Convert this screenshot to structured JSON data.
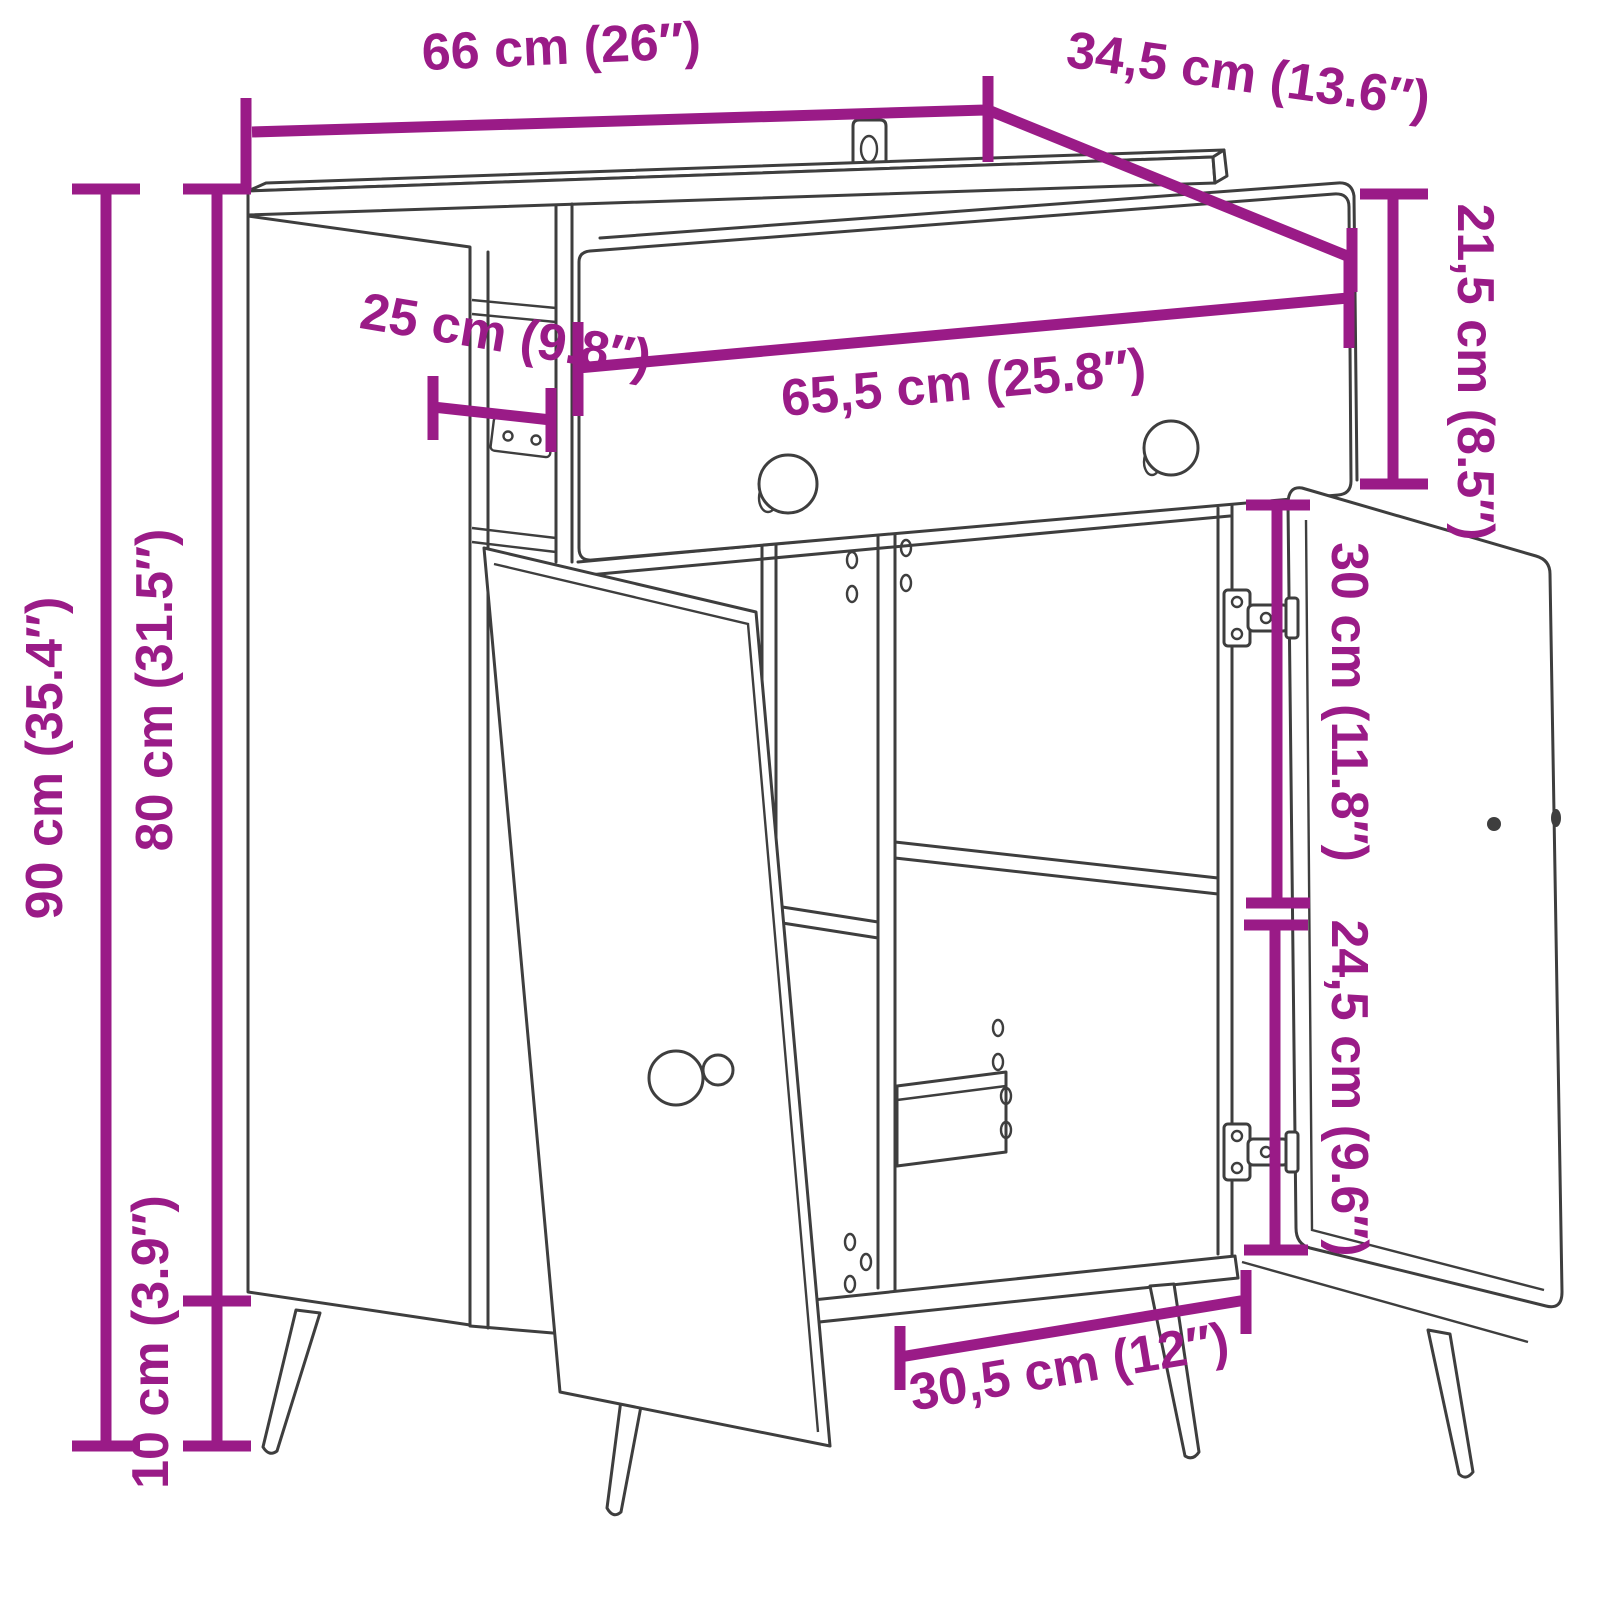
{
  "title": "Sideboard dimension diagram",
  "product": "sideboard with one drawer and two open doors, angled legs, wall-mount bracket",
  "colors": {
    "dimension_annotation": "#9A1B87",
    "line_art": "#3E3E3E",
    "background": "#FFFFFF"
  },
  "dimensions": {
    "top_width": {
      "label": "66 cm (26″)",
      "value_cm": 66,
      "value_in": 26
    },
    "top_depth": {
      "label": "34,5 cm (13.6″)",
      "value_cm": 34.5,
      "value_in": 13.6
    },
    "side_depth": {
      "label": "25 cm (9.8″)",
      "value_cm": 25,
      "value_in": 9.8
    },
    "drawer_width": {
      "label": "65,5 cm (25.8″)",
      "value_cm": 65.5,
      "value_in": 25.8
    },
    "drawer_height": {
      "label": "21,5 cm (8.5″)",
      "value_cm": 21.5,
      "value_in": 8.5
    },
    "upper_compartment_height": {
      "label": "30 cm (11.8″)",
      "value_cm": 30,
      "value_in": 11.8
    },
    "lower_compartment_height": {
      "label": "24,5 cm (9.6″)",
      "value_cm": 24.5,
      "value_in": 9.6
    },
    "total_height": {
      "label": "90 cm (35.4″)",
      "value_cm": 90,
      "value_in": 35.4
    },
    "body_height": {
      "label": "80 cm (31.5″)",
      "value_cm": 80,
      "value_in": 31.5
    },
    "leg_height": {
      "label": "10 cm (3.9″)",
      "value_cm": 10,
      "value_in": 3.9
    },
    "lower_compartment_width": {
      "label": "30,5 cm (12″)",
      "value_cm": 30.5,
      "value_in": 12
    }
  }
}
